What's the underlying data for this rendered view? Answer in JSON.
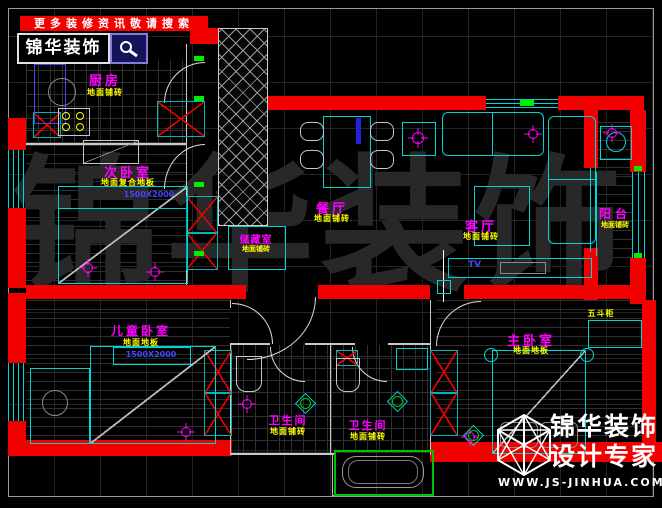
{
  "promo": {
    "banner_text": "更多装修资讯敬请搜索",
    "brand_text": "锦华装饰"
  },
  "watermark_text": "锦华装饰",
  "rooms": {
    "kitchen": {
      "name": "厨房",
      "finish": "地面铺砖"
    },
    "secondary_bedroom": {
      "name": "次卧室",
      "finish": "地面复合地板",
      "bed_size": "1500X2000"
    },
    "storage": {
      "name": "储藏室",
      "finish": "地面铺砖"
    },
    "dining": {
      "name": "餐厅",
      "finish": "地面铺砖"
    },
    "living": {
      "name": "客厅",
      "finish": "地面铺砖"
    },
    "balcony": {
      "name": "阳台",
      "finish": "地面铺砖"
    },
    "children_bedroom": {
      "name": "儿童卧室",
      "finish": "地面地板",
      "bed_size": "1500X2000"
    },
    "master_bedroom": {
      "name": "主卧室",
      "finish": "地面地板",
      "dresser_label": "五斗柜"
    },
    "bathroom_1": {
      "name": "卫生间",
      "finish": "地面铺砖"
    },
    "bathroom_2": {
      "name": "卫生间",
      "finish": "地面铺砖"
    }
  },
  "furniture_labels": {
    "tv": "TV"
  },
  "footer": {
    "brand_line1": "锦华装饰",
    "brand_line2": "设计专家",
    "website": "WWW.JS-JINHUA.COM"
  },
  "colors": {
    "wall_red": "#f20000",
    "furniture_cyan": "#00d5d5",
    "room_label": "#ff00ff",
    "finish_label": "#ffff00",
    "size_label": "#4646ff",
    "switch_green": "#00ee00",
    "background": "#000000"
  }
}
